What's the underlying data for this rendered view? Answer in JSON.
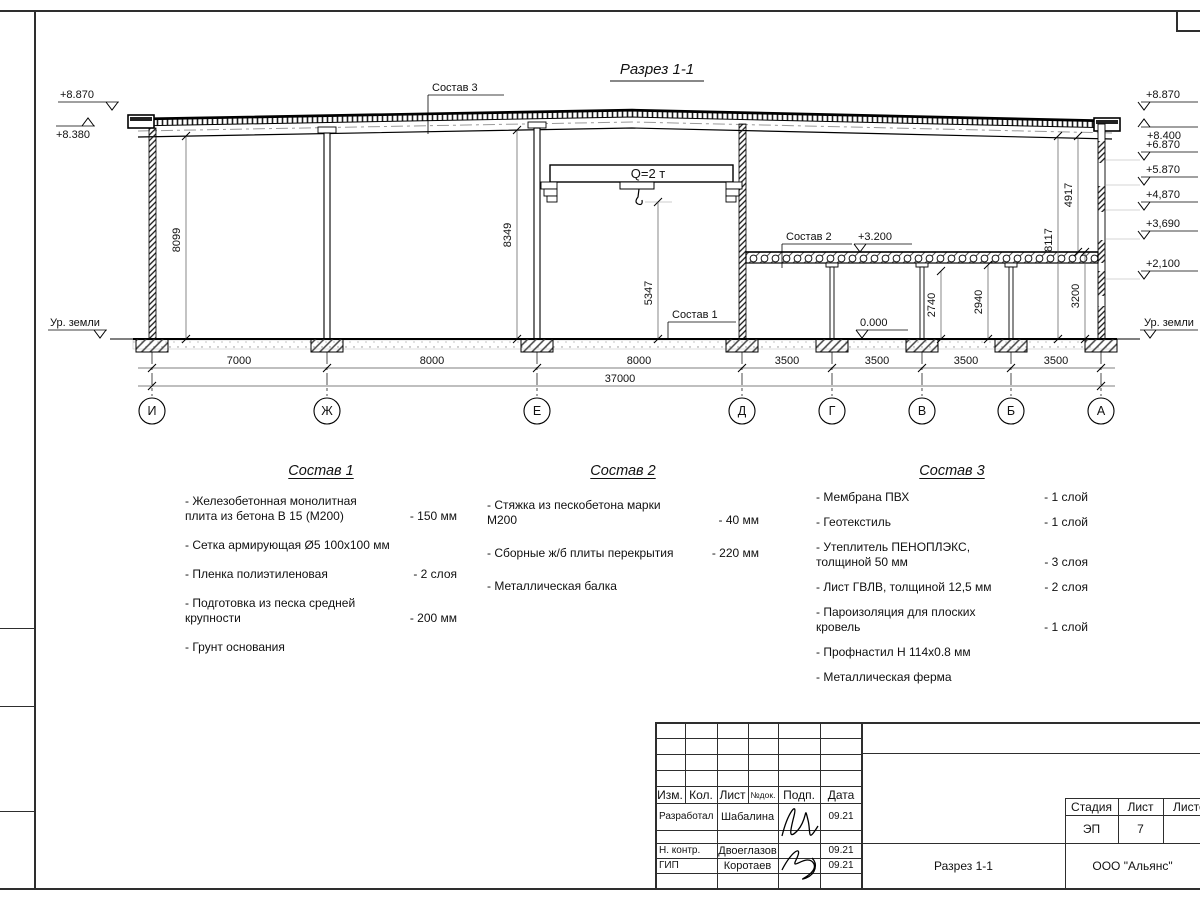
{
  "drawing": {
    "title": "Разрез 1-1",
    "crane_label": "Q=2 т",
    "callouts": {
      "c1": "Состав 1",
      "c2": "Состав 2",
      "c3": "Состав 3"
    },
    "levels_left": {
      "top": "+8.870",
      "eave": "+8.380",
      "ground": "Ур. земли"
    },
    "levels_right": {
      "items": [
        "+8.870",
        "+8.400",
        "+6.870",
        "+5.870",
        "+4,870",
        "+3,690",
        "+2,100"
      ],
      "ground": "Ур. земли"
    },
    "level_marks": {
      "mezzanine": "+3.200",
      "floor": "0.000"
    },
    "vdims": {
      "d8099": "8099",
      "d8349": "8349",
      "d5347": "5347",
      "d2740": "2740",
      "d2940": "2940",
      "d3200": "3200",
      "d8117": "8117",
      "d4917": "4917"
    },
    "bottom_dims": [
      "7000",
      "8000",
      "8000",
      "3500",
      "3500",
      "3500",
      "3500"
    ],
    "total_dim": "37000",
    "axes": [
      "И",
      "Ж",
      "Е",
      "Д",
      "Г",
      "В",
      "Б",
      "А"
    ]
  },
  "compositions": [
    {
      "title": "Состав 1",
      "items": [
        {
          "name": "- Железобетонная  монолитная плита из бетона В 15 (М200)",
          "value": "- 150 мм"
        },
        {
          "name": "- Сетка армирующая Ø5 100х100 мм",
          "value": ""
        },
        {
          "name": "- Пленка полиэтиленовая",
          "value": "- 2 слоя"
        },
        {
          "name": "- Подготовка из песка средней крупности",
          "value": "- 200 мм"
        },
        {
          "name": "- Грунт основания",
          "value": ""
        }
      ]
    },
    {
      "title": "Состав 2",
      "items": [
        {
          "name": "- Стяжка из пескобетона марки М200",
          "value": "- 40 мм"
        },
        {
          "name": "- Сборные ж/б плиты перекрытия",
          "value": "- 220 мм"
        },
        {
          "name": "- Металлическая балка",
          "value": ""
        }
      ]
    },
    {
      "title": "Состав 3",
      "items": [
        {
          "name": "- Мембрана ПВХ",
          "value": "- 1 слой"
        },
        {
          "name": "- Геотекстиль",
          "value": "- 1 слой"
        },
        {
          "name": "- Утеплитель ПЕНОПЛЭКС, толщиной 50 мм",
          "value": "- 3 слоя"
        },
        {
          "name": "- Лист ГВЛВ, толщиной 12,5 мм",
          "value": "- 2 слоя"
        },
        {
          "name": "- Пароизоляция для плоских кровель",
          "value": "- 1 слой"
        },
        {
          "name": "- Профнастил Н 114х0.8 мм",
          "value": ""
        },
        {
          "name": "- Металлическая ферма",
          "value": ""
        }
      ]
    }
  ],
  "titleblock": {
    "rev_headers": [
      "Изм.",
      "Кол.",
      "Лист",
      "№док.",
      "Подп.",
      "Дата"
    ],
    "rows": [
      {
        "role": "Разработал",
        "name": "Шабалина",
        "date": "09.21"
      },
      {
        "role": "Н. контр.",
        "name": "Двоеглазов",
        "date": "09.21"
      },
      {
        "role": "ГИП",
        "name": "Коротаев",
        "date": "09.21"
      }
    ],
    "stage_label": "Стадия",
    "stage_value": "ЭП",
    "sheet_label": "Лист",
    "sheet_value": "7",
    "sheets_label": "Листов",
    "doc_name": "Разрез 1-1",
    "company": "ООО \"Альянс\""
  }
}
